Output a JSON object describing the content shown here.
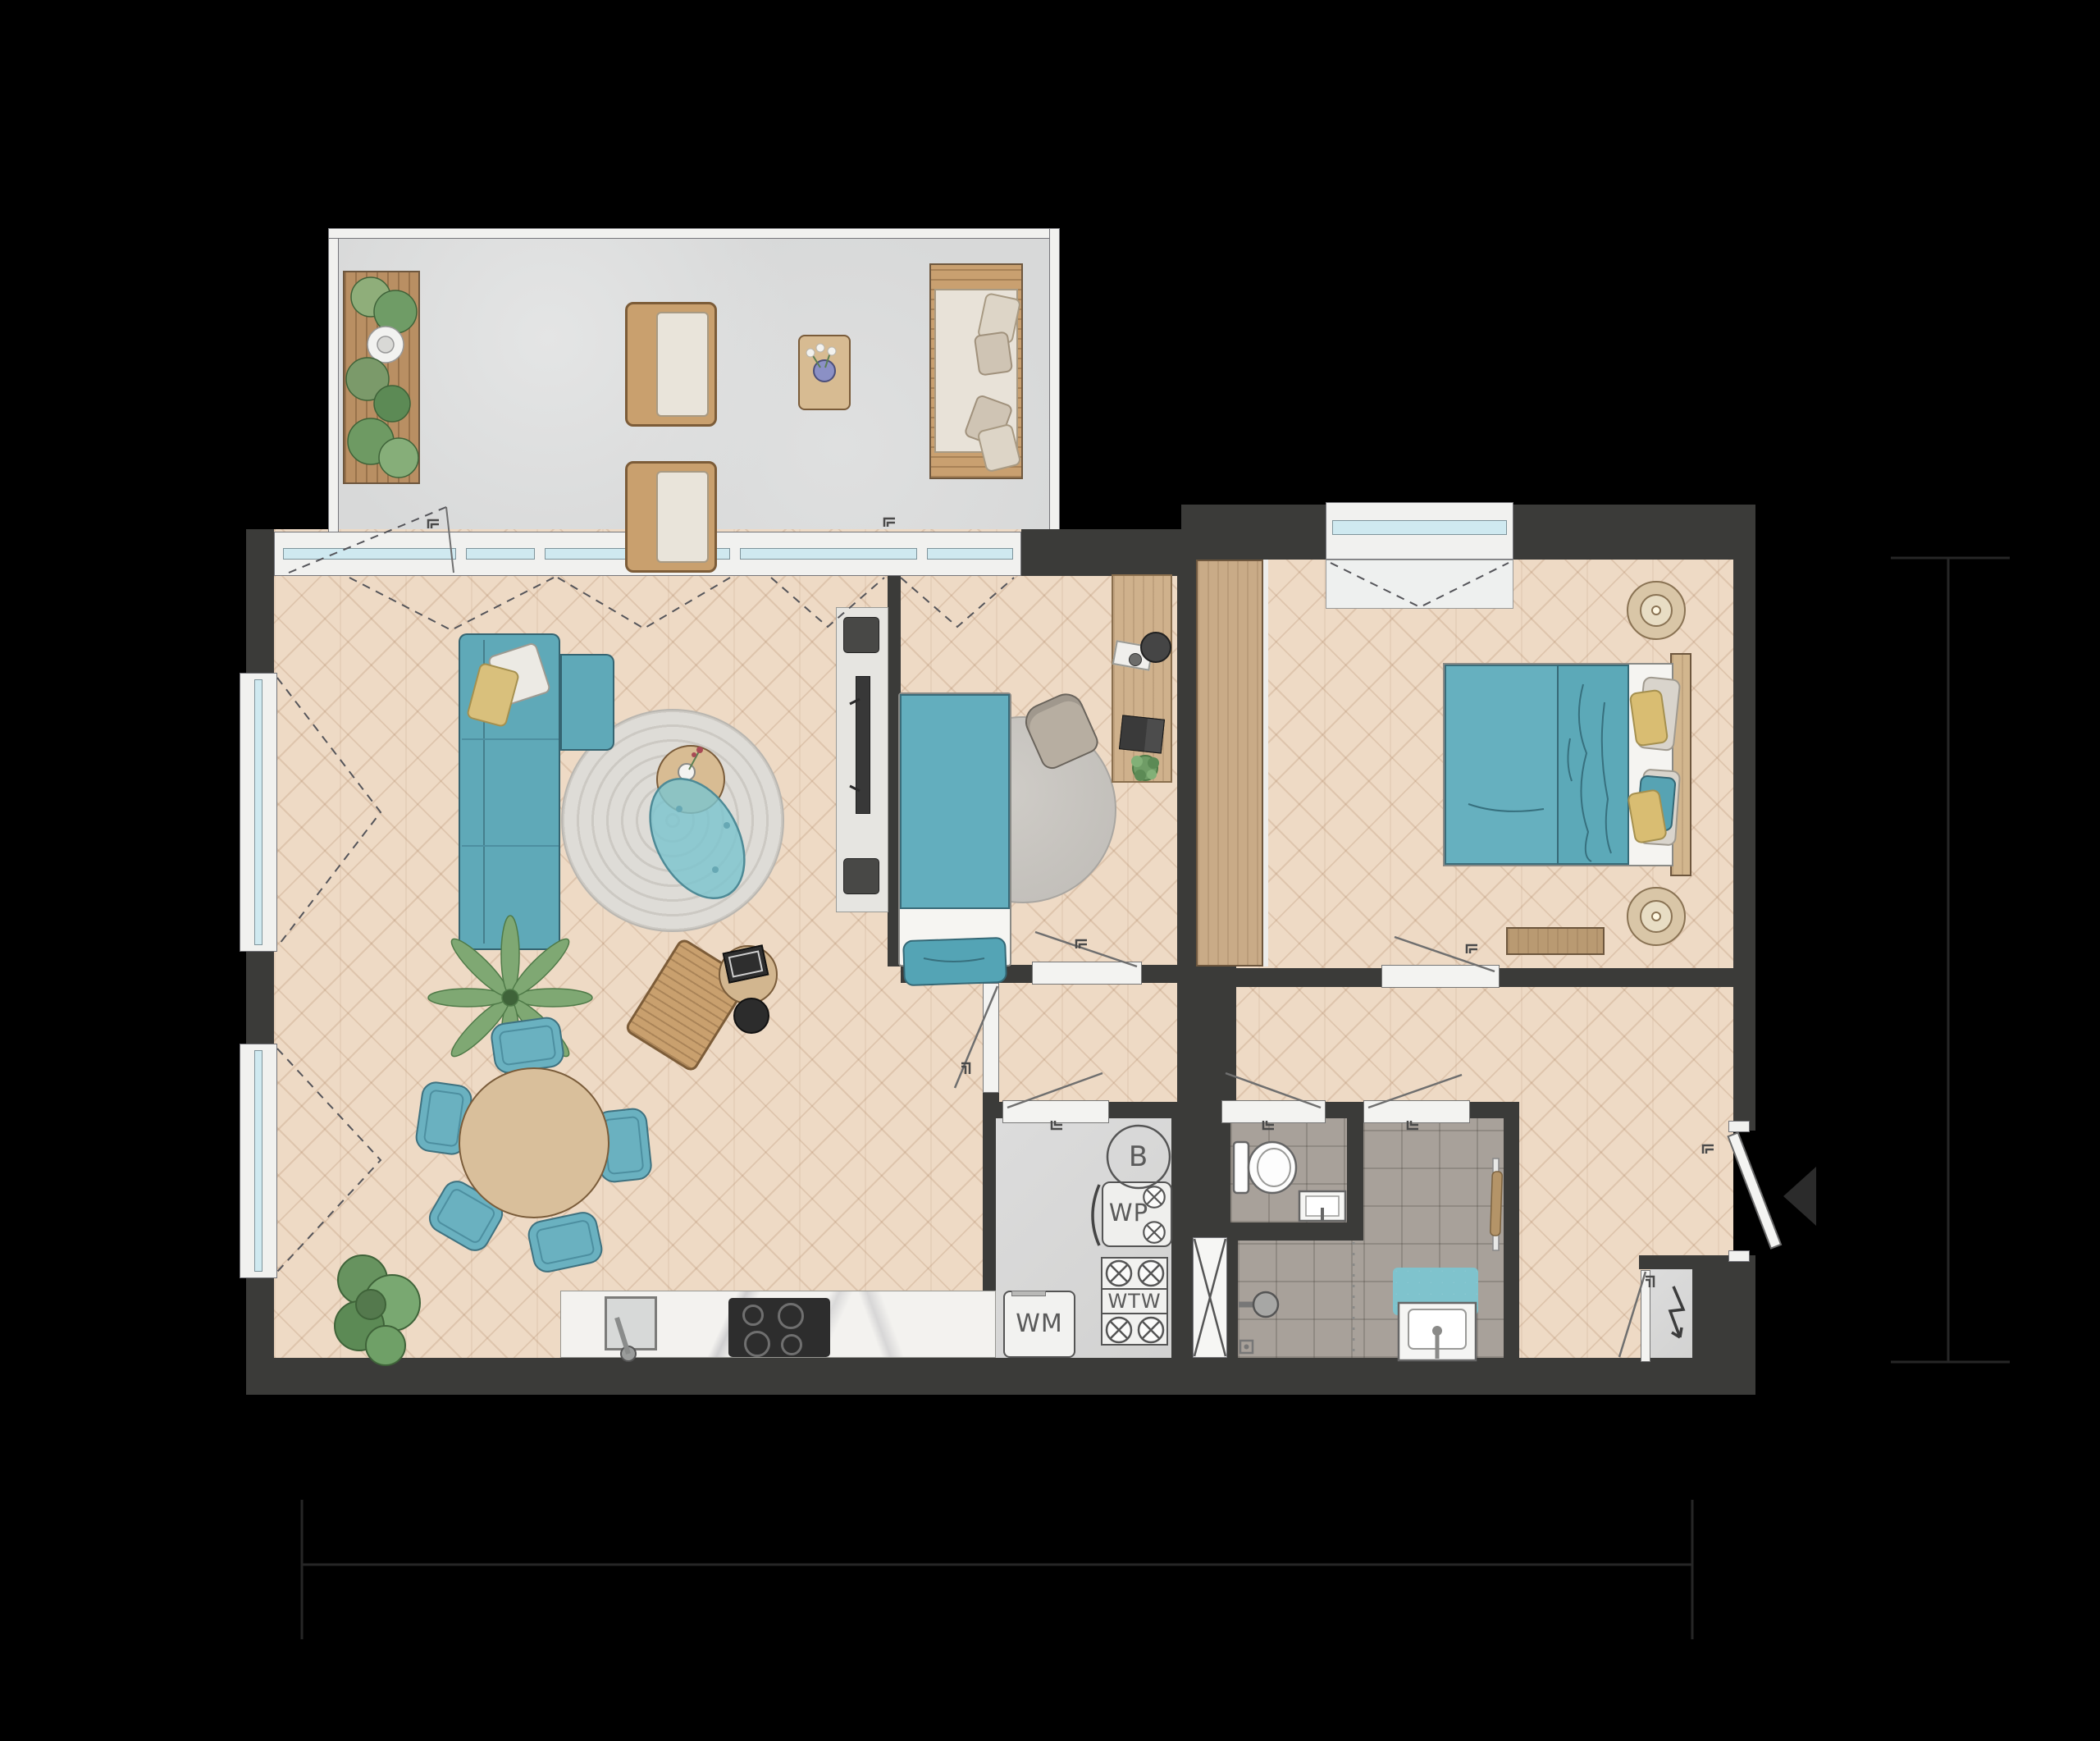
{
  "labels": {
    "boiler": "B",
    "heat_pump": "WP",
    "heat_recovery_unit": "WTW",
    "washing_machine": "WM"
  },
  "colors": {
    "background": "#000000",
    "wall": "#3b3b39",
    "floor_wood": "#eedac5",
    "floor_balcony": "#d8d9d9",
    "floor_tile": "#a8a19a",
    "accent_teal": "#64aebd",
    "accent_yellow": "#d9bd72",
    "wood": "#c9ab87",
    "glass": "#cfe9f0"
  }
}
